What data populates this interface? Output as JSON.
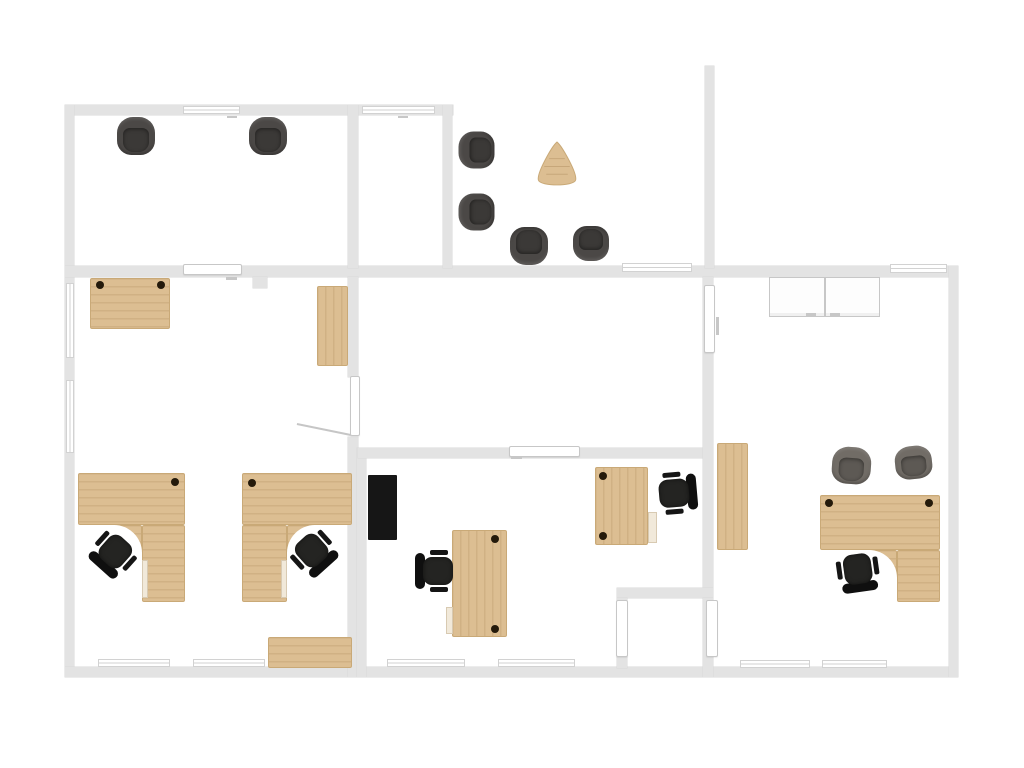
{
  "canvas": {
    "width": 1024,
    "height": 768,
    "background": "#ffffff"
  },
  "palette": {
    "wall": "#e3e3e3",
    "wall_edge": "#d9d9d9",
    "window_line": "#d2d2d2",
    "door_fill": "#ffffff",
    "door_border": "#c7c7c7",
    "wood": "#dcbe92",
    "wood_edge": "#c9a977",
    "wood_grain": "rgba(148,108,60,0.16)",
    "grommet": "#241a0b",
    "pedestal_fill": "#f1e9da",
    "pedestal_border": "#d8cab2",
    "cabinet_fill": "#fdfdfd",
    "cabinet_border": "#c7c7c7",
    "tv": "#161616",
    "office_seat": "#242422",
    "office_back": "#0f0f0f",
    "office_arm": "#151515",
    "tub_dark_outer": "#4b4846",
    "tub_dark_inner": "#3b3937",
    "tub_light_outer": "#716c66",
    "tub_light_inner": "#5d5954",
    "swing_line": "#c6c6c6"
  },
  "walls": [
    {
      "name": "wall-top-left",
      "rect": [
        65,
        105,
        388,
        10
      ]
    },
    {
      "name": "wall-left",
      "rect": [
        65,
        105,
        9,
        572
      ]
    },
    {
      "name": "wall-mid-horizontal",
      "rect": [
        65,
        266,
        893,
        11
      ]
    },
    {
      "name": "wall-bottom",
      "rect": [
        65,
        667,
        893,
        10
      ]
    },
    {
      "name": "wall-right",
      "rect": [
        949,
        266,
        9,
        411
      ]
    },
    {
      "name": "wall-room1-right",
      "rect": [
        348,
        105,
        10,
        163
      ]
    },
    {
      "name": "wall-narrow-room-right",
      "rect": [
        443,
        105,
        9,
        163
      ]
    },
    {
      "name": "wall-lounge-right",
      "rect": [
        705,
        66,
        9,
        202
      ]
    },
    {
      "name": "wall-leftroom-right-upper",
      "rect": [
        348,
        277,
        10,
        100
      ]
    },
    {
      "name": "wall-leftroom-right-lower",
      "rect": [
        348,
        437,
        10,
        240
      ]
    },
    {
      "name": "wall-midroom-left",
      "rect": [
        357,
        448,
        9,
        229
      ]
    },
    {
      "name": "wall-midroom-top",
      "rect": [
        358,
        448,
        347,
        10
      ]
    },
    {
      "name": "wall-rightroom-left",
      "rect": [
        703,
        277,
        10,
        323
      ]
    },
    {
      "name": "wall-alcove-top",
      "rect": [
        617,
        588,
        96,
        10
      ]
    },
    {
      "name": "wall-alcove-left",
      "rect": [
        617,
        598,
        10,
        70
      ]
    },
    {
      "name": "wall-alcove-right",
      "rect": [
        703,
        598,
        10,
        79
      ]
    },
    {
      "name": "wall-column-stub",
      "rect": [
        253,
        277,
        14,
        11
      ]
    }
  ],
  "windows": [
    {
      "name": "window-top-1",
      "rect": [
        183,
        106,
        57,
        8
      ]
    },
    {
      "name": "window-top-2",
      "rect": [
        362,
        106,
        73,
        8
      ]
    },
    {
      "name": "window-mid-lounge",
      "rect": [
        622,
        263,
        70,
        9
      ]
    },
    {
      "name": "window-mid-right",
      "rect": [
        890,
        264,
        57,
        9
      ]
    },
    {
      "name": "window-left-1",
      "rect": [
        66,
        283,
        8,
        75
      ]
    },
    {
      "name": "window-left-2",
      "rect": [
        66,
        380,
        8,
        73
      ]
    },
    {
      "name": "window-bottom-1",
      "rect": [
        98,
        659,
        72,
        8
      ]
    },
    {
      "name": "window-bottom-2",
      "rect": [
        193,
        659,
        72,
        8
      ]
    },
    {
      "name": "window-bottom-3",
      "rect": [
        387,
        659,
        78,
        8
      ]
    },
    {
      "name": "window-bottom-4",
      "rect": [
        498,
        659,
        77,
        8
      ]
    },
    {
      "name": "window-bottom-5",
      "rect": [
        740,
        660,
        70,
        8
      ]
    },
    {
      "name": "window-bottom-6",
      "rect": [
        822,
        660,
        65,
        8
      ]
    }
  ],
  "doors": [
    {
      "name": "door-midwall-sliding",
      "kind": "bar",
      "rect": [
        183,
        264,
        59,
        11
      ]
    },
    {
      "name": "door-midroom-top",
      "kind": "bar",
      "rect": [
        509,
        446,
        71,
        11
      ]
    },
    {
      "name": "door-leftroom-leaf",
      "kind": "leaf",
      "rect": [
        350,
        376,
        10,
        60
      ]
    },
    {
      "name": "door-rightroom-leaf",
      "kind": "leaf",
      "rect": [
        704,
        285,
        11,
        68
      ]
    },
    {
      "name": "door-alcove-left-leaf",
      "kind": "leaf",
      "rect": [
        616,
        600,
        12,
        57
      ]
    },
    {
      "name": "door-alcove-right-leaf",
      "kind": "leaf",
      "rect": [
        706,
        600,
        12,
        57
      ]
    }
  ],
  "marks": [
    {
      "name": "door-handle-mark-1",
      "rect": [
        226,
        277,
        11,
        3
      ]
    },
    {
      "name": "door-handle-mark-2",
      "rect": [
        511,
        456,
        11,
        3
      ]
    },
    {
      "name": "door-handle-mark-3",
      "rect": [
        716,
        317,
        3,
        18
      ]
    },
    {
      "name": "window-handle-mark-1",
      "rect": [
        227,
        116,
        10,
        2
      ]
    },
    {
      "name": "window-handle-mark-2",
      "rect": [
        398,
        116,
        10,
        2
      ]
    }
  ],
  "swing_line": {
    "name": "door-swing-line",
    "x": 297,
    "y": 423,
    "length": 55,
    "angle_deg": 11.5
  },
  "wood_pieces": [
    {
      "name": "desk-top-left-room",
      "rect": [
        90,
        278,
        80,
        51
      ],
      "grain": "h"
    },
    {
      "name": "shelf-left-room",
      "rect": [
        317,
        286,
        31,
        80
      ],
      "grain": "v"
    },
    {
      "name": "corner-desk-1-slab",
      "rect": [
        78,
        473,
        107,
        52
      ],
      "grain": "h"
    },
    {
      "name": "corner-desk-1-leg",
      "rect": [
        142,
        525,
        43,
        77
      ],
      "grain": "h"
    },
    {
      "name": "corner-desk-1-fillet-patch",
      "rect": [
        114,
        525,
        28,
        28
      ],
      "grain": "h"
    },
    {
      "name": "corner-desk-2-slab",
      "rect": [
        242,
        473,
        110,
        52
      ],
      "grain": "h"
    },
    {
      "name": "corner-desk-2-leg",
      "rect": [
        242,
        525,
        45,
        77
      ],
      "grain": "h"
    },
    {
      "name": "corner-desk-2-fillet-patch",
      "rect": [
        287,
        525,
        28,
        28
      ],
      "grain": "h"
    },
    {
      "name": "sideboard-left-room",
      "rect": [
        268,
        637,
        84,
        31
      ],
      "grain": "h"
    },
    {
      "name": "desk-mid-room",
      "rect": [
        452,
        530,
        55,
        107
      ],
      "grain": "v"
    },
    {
      "name": "desk-open-area",
      "rect": [
        595,
        467,
        53,
        78
      ],
      "grain": "v"
    },
    {
      "name": "tall-cabinet-right-room",
      "rect": [
        717,
        443,
        31,
        107
      ],
      "grain": "v"
    },
    {
      "name": "corner-desk-3-slab",
      "rect": [
        820,
        495,
        120,
        55
      ],
      "grain": "h"
    },
    {
      "name": "corner-desk-3-leg",
      "rect": [
        897,
        550,
        43,
        52
      ],
      "grain": "h"
    },
    {
      "name": "corner-desk-3-fillet-patch",
      "rect": [
        869,
        550,
        28,
        28
      ],
      "grain": "h"
    }
  ],
  "fillets": [
    {
      "name": "desk-fillet-cut-1",
      "cx": 114,
      "cy": 553,
      "r": 28
    },
    {
      "name": "desk-fillet-cut-2",
      "cx": 315,
      "cy": 553,
      "r": 28
    },
    {
      "name": "desk-fillet-cut-3",
      "cx": 869,
      "cy": 578,
      "r": 28
    }
  ],
  "grommets": [
    {
      "x": 100,
      "y": 285
    },
    {
      "x": 161,
      "y": 285
    },
    {
      "x": 175,
      "y": 482
    },
    {
      "x": 252,
      "y": 483
    },
    {
      "x": 495,
      "y": 539
    },
    {
      "x": 495,
      "y": 629
    },
    {
      "x": 603,
      "y": 476
    },
    {
      "x": 603,
      "y": 536
    },
    {
      "x": 829,
      "y": 503
    },
    {
      "x": 929,
      "y": 503
    }
  ],
  "pedestals": [
    {
      "name": "drawer-unit-desk1",
      "rect": [
        142,
        560,
        6,
        38
      ]
    },
    {
      "name": "drawer-unit-desk2",
      "rect": [
        281,
        560,
        6,
        38
      ]
    },
    {
      "name": "drawer-unit-mid-desk",
      "rect": [
        446,
        607,
        7,
        27
      ]
    },
    {
      "name": "drawer-unit-open-desk",
      "rect": [
        648,
        512,
        9,
        31
      ]
    }
  ],
  "cabinets": [
    {
      "name": "storage-cabinet-1",
      "rect": [
        769,
        277,
        56,
        40
      ]
    },
    {
      "name": "storage-cabinet-2",
      "rect": [
        825,
        277,
        55,
        40
      ]
    }
  ],
  "cabinet_handles": [
    {
      "rect": [
        806,
        313,
        10,
        3
      ]
    },
    {
      "rect": [
        830,
        313,
        10,
        3
      ]
    }
  ],
  "tv": {
    "name": "wall-tv-screen",
    "rect": [
      368,
      475,
      29,
      65
    ]
  },
  "triangle_table": {
    "name": "lounge-triangle-table",
    "x": 533,
    "y": 141,
    "w": 48,
    "h": 47
  },
  "office_chairs": [
    {
      "name": "office-chair-corner-desk-1",
      "cx": 114,
      "cy": 553,
      "rot": 42
    },
    {
      "name": "office-chair-corner-desk-2",
      "cx": 313,
      "cy": 552,
      "rot": -42
    },
    {
      "name": "office-chair-mid-room",
      "cx": 436,
      "cy": 571,
      "rot": 90
    },
    {
      "name": "office-chair-open-area",
      "cx": 676,
      "cy": 493,
      "rot": -95
    },
    {
      "name": "office-chair-corner-desk-3",
      "cx": 858,
      "cy": 571,
      "rot": -8
    }
  ],
  "tub_chairs": [
    {
      "name": "tub-chair-room1-a",
      "cx": 136,
      "cy": 136,
      "w": 38,
      "h": 38,
      "rot": 0,
      "variant": "dark"
    },
    {
      "name": "tub-chair-room1-b",
      "cx": 268,
      "cy": 136,
      "w": 38,
      "h": 38,
      "rot": 0,
      "variant": "dark"
    },
    {
      "name": "tub-chair-lounge-a",
      "cx": 476,
      "cy": 150,
      "w": 37,
      "h": 36,
      "rot": -90,
      "variant": "dark"
    },
    {
      "name": "tub-chair-lounge-b",
      "cx": 476,
      "cy": 212,
      "w": 37,
      "h": 36,
      "rot": -90,
      "variant": "dark"
    },
    {
      "name": "tub-chair-lounge-c",
      "cx": 529,
      "cy": 246,
      "w": 38,
      "h": 38,
      "rot": 180,
      "variant": "dark"
    },
    {
      "name": "tub-chair-lounge-d",
      "cx": 591,
      "cy": 243,
      "w": 36,
      "h": 35,
      "rot": 180,
      "variant": "dark"
    },
    {
      "name": "visitor-chair-right-room-a",
      "cx": 851,
      "cy": 465,
      "w": 39,
      "h": 37,
      "rot": 4,
      "variant": "light"
    },
    {
      "name": "visitor-chair-right-room-b",
      "cx": 913,
      "cy": 462,
      "w": 37,
      "h": 33,
      "rot": -6,
      "variant": "light"
    }
  ]
}
